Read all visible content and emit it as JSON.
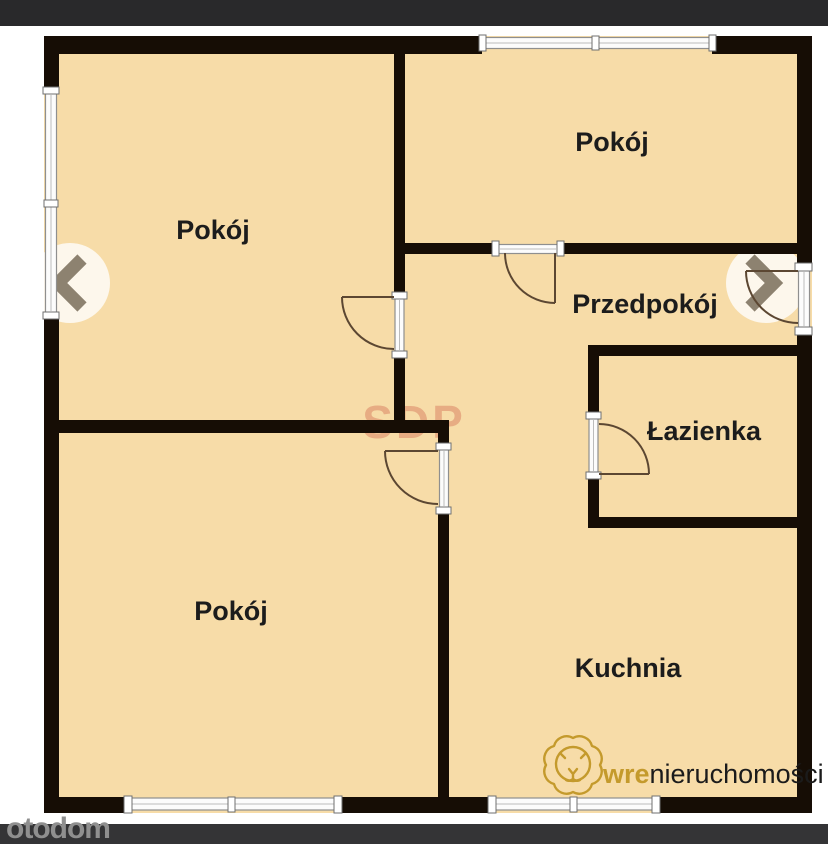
{
  "floorplan": {
    "rooms": [
      {
        "id": "room-top-left",
        "label": "Pokój"
      },
      {
        "id": "room-top-right",
        "label": "Pokój"
      },
      {
        "id": "hallway",
        "label": "Przedpokój"
      },
      {
        "id": "bathroom",
        "label": "Łazienka"
      },
      {
        "id": "room-bottom-left",
        "label": "Pokój"
      },
      {
        "id": "kitchen",
        "label": "Kuchnia"
      }
    ],
    "watermark": "SDP",
    "colors": {
      "floor": "#f7dca8",
      "wall": "#160d05",
      "window_frame": "#8f8f8f",
      "door_arc": "#5c4732",
      "watermark_red": "#c8543e"
    }
  },
  "branding": {
    "agency_logo_bold": "wre",
    "agency_logo_rest": "nieruchomości",
    "agency_gold": "#c49a2c",
    "portal_logo": "otodom"
  },
  "viewer": {
    "top_bar_color": "#29292b",
    "bottom_bar_color": "#343436"
  }
}
